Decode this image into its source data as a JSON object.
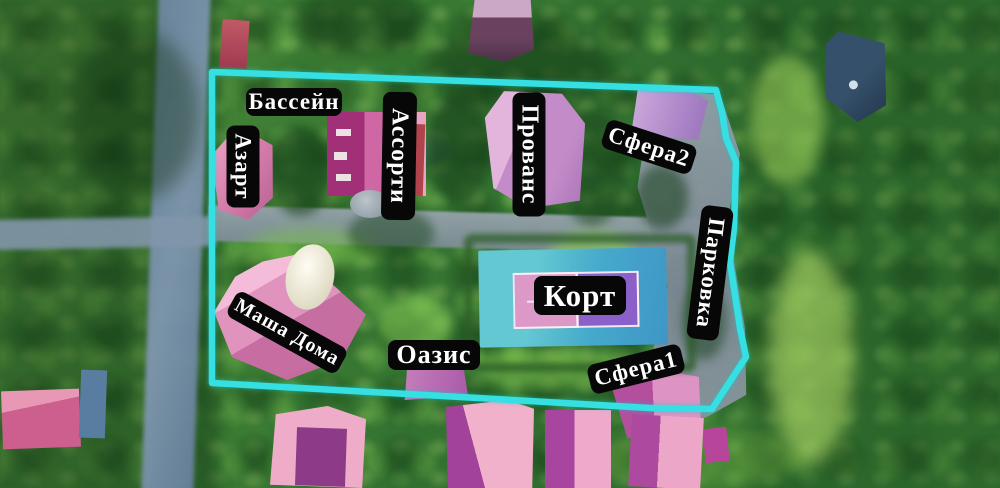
{
  "scene": {
    "description": "Aerial drone photo of guest-house grounds with labeled buildings and cyan property boundary",
    "boundary_color": "#35dfe2",
    "label_background": "#070707",
    "label_text_color": "#ffffff"
  },
  "labels": {
    "bassein": "Бассейн",
    "azart": "Азарт",
    "assorti": "Ассорти",
    "provans": "Прованс",
    "sfera2": "Сфера2",
    "parkovka": "Парковка",
    "kort": "Корт",
    "masha_doma": "Маша Дома",
    "oazis": "Оазис",
    "sfera1": "Сфера1"
  },
  "colors": {
    "vegetation_dark": "#2e6b2e",
    "vegetation_bright": "#8fd054",
    "road_gray": "#8296aa",
    "roof_pink": "#eba8c6",
    "roof_magenta": "#a2429a",
    "roof_lavender": "#c38cc8",
    "court_deck_teal": "#46aacb",
    "court_pink_half": "#dc99c8",
    "court_purple_half": "#8b60c8",
    "dome_white": "#fffdf2"
  }
}
